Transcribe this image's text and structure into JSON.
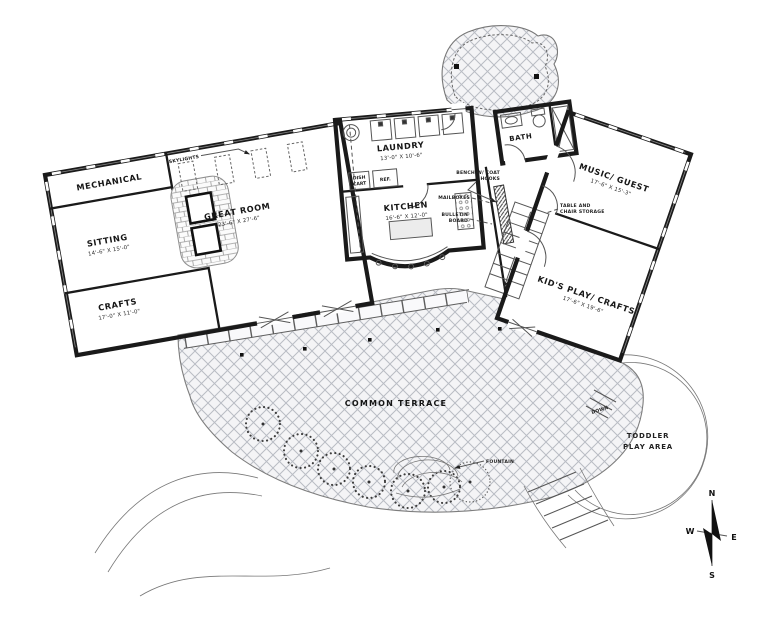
{
  "document": {
    "type": "architectural-floor-plan",
    "ink_color": "#1a1a1a",
    "hatch_color": "#b9bcc4"
  },
  "rooms": {
    "mechanical": {
      "name": "MECHANICAL"
    },
    "sitting": {
      "name": "SITTING",
      "dims": "14'-6\" X 15'-0\""
    },
    "crafts": {
      "name": "CRAFTS",
      "dims": "17'-0\" X 11'-0\""
    },
    "great_room": {
      "name": "GREAT ROOM",
      "dims": "23'-6\" X 27'-6\""
    },
    "laundry": {
      "name": "LAUNDRY",
      "dims": "13'-0\" X 10'-6\""
    },
    "kitchen": {
      "name": "KITCHEN",
      "dims": "16'-6\" X 12'-0\""
    },
    "bath": {
      "name": "BATH"
    },
    "music_guest": {
      "name": "MUSIC/ GUEST",
      "dims": "17'-6\" X 15'-3\""
    },
    "kids_play": {
      "name": "KID'S PLAY/ CRAFTS",
      "dims": "17'-6\" X 19'-6\""
    },
    "common_terrace": {
      "name": "COMMON TERRACE"
    },
    "toddler": {
      "line1": "TODDLER",
      "line2": "PLAY AREA"
    }
  },
  "annotations": {
    "skylights": "SKYLIGHTS",
    "dish_cart_line1": "DISH",
    "dish_cart_line2": "CART",
    "fridge": "REF.",
    "bench_line1": "BENCH W/ COAT",
    "bench_line2": "HOOKS",
    "mailboxes": "MAILBOXES",
    "bulletin_line1": "BULLETIN",
    "bulletin_line2": "BOARD",
    "storage_line1": "TABLE AND",
    "storage_line2": "CHAIR STORAGE",
    "down": "DOWN",
    "fountain": "FOUNTAIN"
  },
  "compass": {
    "north": "N",
    "east": "E",
    "south": "S",
    "west": "W"
  }
}
